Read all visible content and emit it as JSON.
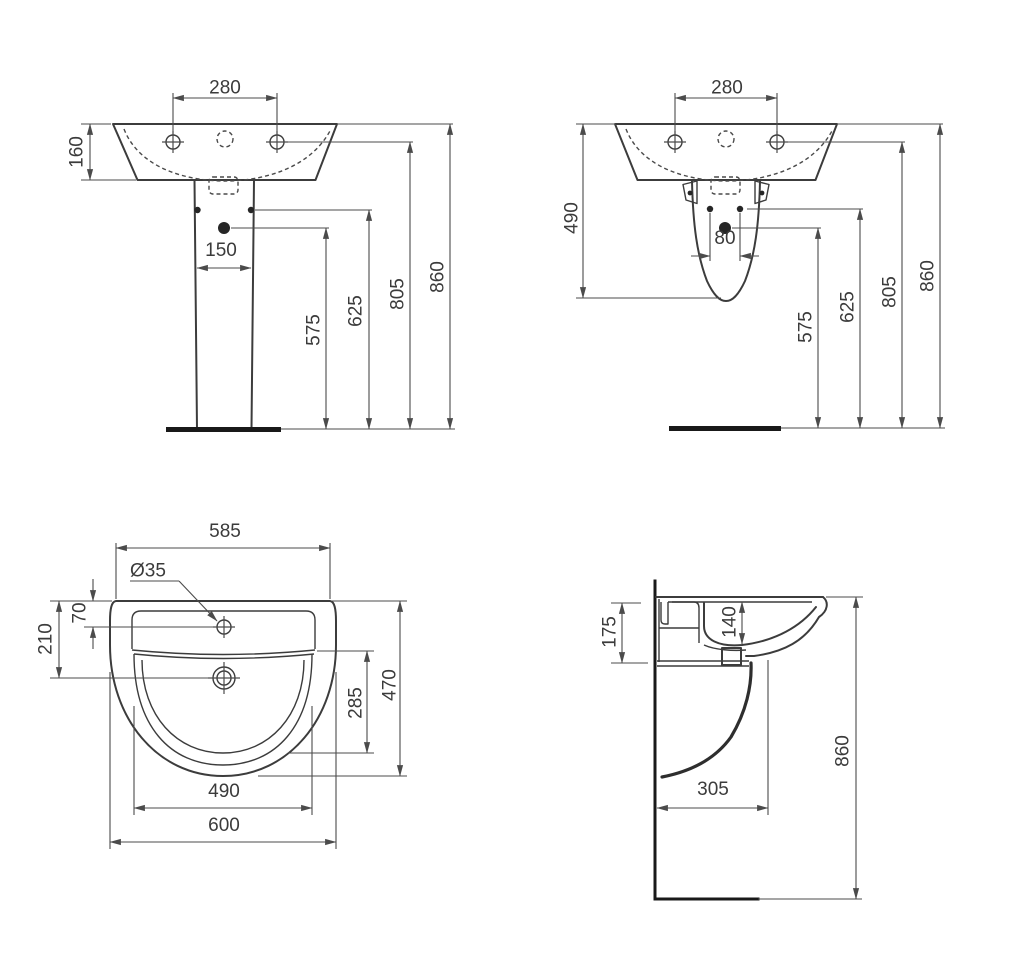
{
  "colors": {
    "background": "#ffffff",
    "outline": "#3c3c3c",
    "dimension_lines": "#4b4b4b",
    "text": "#3b3b3b",
    "heavy_lines": "#191919"
  },
  "views": {
    "front_full_pedestal": {
      "dims": {
        "tap_spacing": "280",
        "basin_height": "160",
        "pedestal_width": "150",
        "height_to_drain": "575",
        "height_to_fixings": "625",
        "height_to_tapholes": "805",
        "height_total": "860"
      }
    },
    "front_semi_pedestal": {
      "dims": {
        "tap_spacing": "280",
        "semi_pedestal_height": "490",
        "fixing_hole_spacing": "80",
        "height_to_drain": "575",
        "height_to_fixings": "625",
        "height_to_tapholes": "805",
        "height_total": "860"
      }
    },
    "plan": {
      "dims": {
        "back_width": "585",
        "taphole_diameter": "Ø35",
        "taphole_offset": "70",
        "drain_offset": "210",
        "bowl_depth": "285",
        "overall_depth": "470",
        "bowl_width": "490",
        "overall_width": "600"
      }
    },
    "side": {
      "dims": {
        "rim_height": "175",
        "bowl_inner_depth": "140",
        "drain_distance": "305",
        "height_total": "860"
      }
    }
  }
}
